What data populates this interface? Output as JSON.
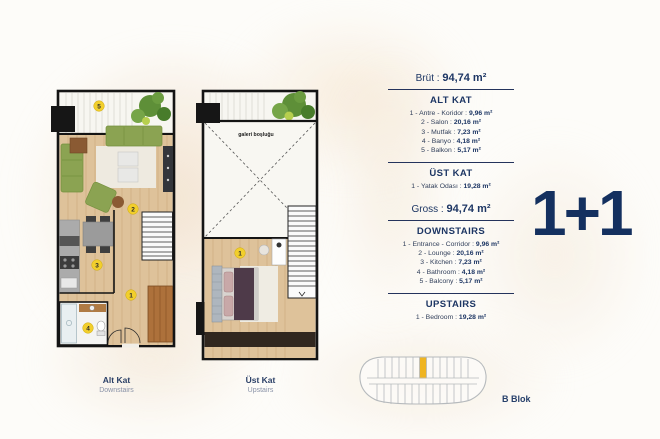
{
  "unit_type": "1+1",
  "info_panel": {
    "brut": {
      "label": "Brüt :",
      "value": "94,74 m²"
    },
    "gross": {
      "label": "Gross :",
      "value": "94,74 m²"
    },
    "alt_kat": {
      "heading": "ALT KAT",
      "rooms": [
        {
          "label": "1 - Antre - Koridor :",
          "value": "9,96 m²"
        },
        {
          "label": "2 - Salon :",
          "value": "20,16 m²"
        },
        {
          "label": "3 - Mutfak :",
          "value": "7,23 m²"
        },
        {
          "label": "4 - Banyo :",
          "value": "4,18 m²"
        },
        {
          "label": "5 - Balkon :",
          "value": "5,17 m²"
        }
      ]
    },
    "ust_kat": {
      "heading": "ÜST KAT",
      "rooms": [
        {
          "label": "1 - Yatak Odası :",
          "value": "19,28 m²"
        }
      ]
    },
    "downstairs": {
      "heading": "DOWNSTAIRS",
      "rooms": [
        {
          "label": "1 - Entrance - Corridor :",
          "value": "9,96 m²"
        },
        {
          "label": "2 - Lounge :",
          "value": "20,16 m²"
        },
        {
          "label": "3 - Kitchen :",
          "value": "7,23 m²"
        },
        {
          "label": "4 - Bathroom :",
          "value": "4,18 m²"
        },
        {
          "label": "5 - Balcony :",
          "value": "5,17 m²"
        }
      ]
    },
    "upstairs": {
      "heading": "UPSTAIRS",
      "rooms": [
        {
          "label": "1 - Bedroom :",
          "value": "19,28 m²"
        }
      ]
    }
  },
  "plans": {
    "alt_kat": {
      "label": "Alt Kat",
      "sublabel": "Downstairs",
      "markers": {
        "balcony": "5",
        "lounge": "2",
        "kitchen": "3",
        "corridor": "1",
        "bathroom": "4"
      }
    },
    "ust_kat": {
      "label": "Üst Kat",
      "sublabel": "Upstairs",
      "void_label": "galeri boşluğu",
      "markers": {
        "bedroom": "1"
      }
    }
  },
  "block_diagram": {
    "label": "B Blok"
  },
  "colors": {
    "navy": "#1d3664",
    "marker_yellow": "#F2CF2C",
    "block_highlight": "#EFB421",
    "wood_floor": "#dec29a",
    "sofa_green": "#8ba352"
  }
}
